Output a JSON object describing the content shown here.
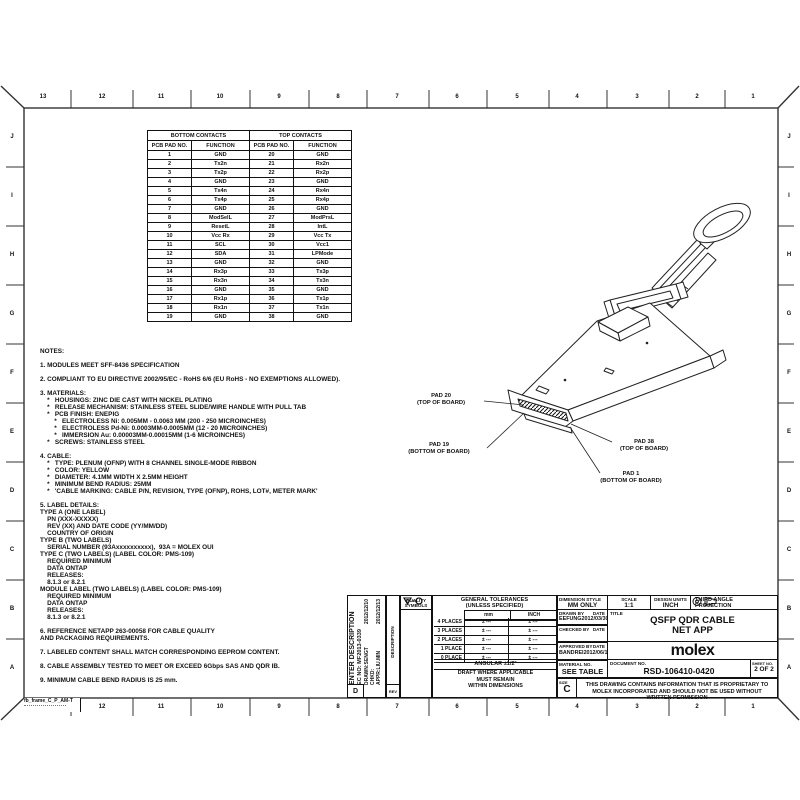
{
  "frame": {
    "top_columns": [
      "13",
      "12",
      "11",
      "10",
      "9",
      "8",
      "7",
      "6",
      "5",
      "4",
      "3",
      "2",
      "1"
    ],
    "bottom_columns": [
      "12",
      "11",
      "10",
      "9",
      "8",
      "7",
      "6",
      "5",
      "4",
      "3",
      "2",
      "1"
    ],
    "rows": [
      "J",
      "I",
      "H",
      "G",
      "F",
      "E",
      "D",
      "C",
      "B",
      "A"
    ],
    "corner_note": "fb_frame_C_P_AM-T"
  },
  "contacts_table": {
    "group_headers": [
      "BOTTOM CONTACTS",
      "TOP CONTACTS"
    ],
    "col_headers": [
      "PCB PAD NO.",
      "FUNCTION",
      "PCB PAD NO.",
      "FUNCTION"
    ],
    "rows": [
      [
        "1",
        "GND",
        "20",
        "GND"
      ],
      [
        "2",
        "Tx2n",
        "21",
        "Rx2n"
      ],
      [
        "3",
        "Tx2p",
        "22",
        "Rx2p"
      ],
      [
        "4",
        "GND",
        "23",
        "GND"
      ],
      [
        "5",
        "Tx4n",
        "24",
        "Rx4n"
      ],
      [
        "6",
        "Tx4p",
        "25",
        "Rx4p"
      ],
      [
        "7",
        "GND",
        "26",
        "GND"
      ],
      [
        "8",
        "ModSelL",
        "27",
        "ModPrsL"
      ],
      [
        "9",
        "ResetL",
        "28",
        "IntL"
      ],
      [
        "10",
        "Vcc Rx",
        "29",
        "Vcc Tx"
      ],
      [
        "11",
        "SCL",
        "30",
        "Vcc1"
      ],
      [
        "12",
        "SDA",
        "31",
        "LPMode"
      ],
      [
        "13",
        "GND",
        "32",
        "GND"
      ],
      [
        "14",
        "Rx3p",
        "33",
        "Tx3p"
      ],
      [
        "15",
        "Rx3n",
        "34",
        "Tx3n"
      ],
      [
        "16",
        "GND",
        "35",
        "GND"
      ],
      [
        "17",
        "Rx1p",
        "36",
        "Tx1p"
      ],
      [
        "18",
        "Rx1n",
        "37",
        "Tx1n"
      ],
      [
        "19",
        "GND",
        "38",
        "GND"
      ]
    ]
  },
  "notes": {
    "text": "NOTES:\n\n1. MODULES MEET SFF-8436 SPECIFICATION\n\n2. COMPLIANT TO EU DIRECTIVE 2002/95/EC - RoHS 6/6 (EU RoHS - NO EXEMPTIONS ALLOWED).\n\n3. MATERIALS:\n    *   HOUSINGS: ZINC DIE CAST WITH NICKEL PLATING\n    *   RELEASE MECHANISM: STAINLESS STEEL SLIDE/WIRE HANDLE WITH PULL TAB\n    *   PCB FINISH: ENEPIG\n        *   ELECTROLESS Ni: 0.005MM - 0.0063 MM (200 - 250 MICROINCHES)\n        *   ELECTROLESS Pd-Ni: 0.0003MM-0.0005MM (12 - 20 MICROINCHES)\n        *   IMMERSION Au: 0.00003MM-0.00015MM (1-6 MICROINCHES)\n    *   SCREWS: STAINLESS STEEL\n\n4. CABLE:\n    *   TYPE: PLENUM (OFNP) WITH 8 CHANNEL SINGLE-MODE RIBBON\n    *   COLOR: YELLOW\n    *   DIAMETER: 4.1MM WIDTH X 2.5MM HEIGHT\n    *   MINIMUM BEND RADIUS: 25MM\n    *   'CABLE MARKING: CABLE P/N, REVISION, TYPE (OFNP), ROHS, LOT#, METER MARK'\n\n5. LABEL DETAILS:\nTYPE A (ONE LABEL)\n    PN (XXX-XXXXX)\n    REV (XX) AND DATE CODE (YY/MM/DD)\n    COUNTRY OF ORIGIN\nTYPE B (TWO LABELS)\n    SERIAL NUMBER (93Axxxxxxxxxx),  93A = MOLEX OUI\nTYPE C (TWO LABELS) (LABEL COLOR: PMS-109)\n    REQUIRED MINIMUM\n    DATA ONTAP\n    RELEASES:\n    8.1.3 or 8.2.1\nMODULE LABEL (TWO LABELS) (LABEL COLOR: PMS-109)\n    REQUIRED MINIMUM\n    DATA ONTAP\n    RELEASES:\n    8.1.3 or 8.2.1\n\n6. REFERENCE NETAPP 263-00058 FOR CABLE QUALITY\nAND PACKAGING REQUIREMENTS.\n\n7. LABELED CONTENT SHALL MATCH CORRESPONDING EEPROM CONTENT.\n\n8. CABLE ASSEMBLY TESTED TO MEET OR EXCEED 6Gbps SAS AND QDR IB.\n\n9. MINIMUM CABLE BEND RADIUS IS 25 mm."
  },
  "drawing": {
    "pad20": {
      "l1": "PAD 20",
      "l2": "(TOP OF BOARD)"
    },
    "pad19": {
      "l1": "PAD 19",
      "l2": "(BOTTOM OF BOARD)"
    },
    "pad38": {
      "l1": "PAD 38",
      "l2": "(TOP OF BOARD)"
    },
    "pad1": {
      "l1": "PAD 1",
      "l2": "(BOTTOM OF BOARD)"
    }
  },
  "title_block": {
    "revision": {
      "enter_description": "ENTER DESCRIPTION",
      "ec_no": "EC NO: MF2013-0339",
      "drawn": "DRAWN:SENGT",
      "drawn_date": "2012/12/10",
      "chkd": "CHKD:",
      "appr": "APPR:LIU.MIN",
      "appr_date": "2012/12/13",
      "description_label": "DESCRIPTION",
      "rev_label": "REV",
      "rev_letter": "D"
    },
    "quality": {
      "header1": "QUALITY",
      "header2": "SYMBOLS"
    },
    "tolerances": {
      "title1": "GENERAL TOLERANCES",
      "title2": "(UNLESS SPECIFIED)",
      "col_mm": "mm",
      "col_inch": "INCH",
      "rows": [
        {
          "label": "4 PLACES",
          "mm": "± ---",
          "inch": "± ---"
        },
        {
          "label": "3 PLACES",
          "mm": "± ---",
          "inch": "± ---"
        },
        {
          "label": "2 PLACES",
          "mm": "± ---",
          "inch": "± ---"
        },
        {
          "label": "1 PLACE",
          "mm": "± ---",
          "inch": "± ---"
        },
        {
          "label": "0 PLACE",
          "mm": "± ---",
          "inch": "± ---"
        }
      ],
      "angular": "ANGULAR ±1/2°",
      "draft_note": "DRAFT WHERE APPLICABLE\nMUST REMAIN\nWITHIN DIMENSIONS"
    },
    "dimension_style": {
      "label": "DIMENSION STYLE",
      "value": "MM ONLY"
    },
    "drawn_by": {
      "label": "DRAWN BY",
      "date_label": "DATE",
      "name": "EEFUNG",
      "date": "2012/03/30"
    },
    "checked_by": {
      "label": "CHECKED BY",
      "date_label": "DATE",
      "name": "",
      "date": ""
    },
    "approved_by": {
      "label": "APPROVED BY",
      "date_label": "DATE",
      "name": "BANDREI",
      "date": "2012/06/18"
    },
    "material": {
      "label": "MATERIAL NO.",
      "value": "SEE TABLE"
    },
    "scale": {
      "label": "SCALE",
      "value": "1:1"
    },
    "design_units": {
      "label": "DESIGN UNITS",
      "value": "INCH"
    },
    "projection": {
      "line1": "THIRD ANGLE",
      "line2": "PROJECTION"
    },
    "title": {
      "label": "TITLE",
      "line1": "QSFP QDR CABLE",
      "line2": "NET APP"
    },
    "logo": "molex",
    "document_no": {
      "label": "DOCUMENT NO.",
      "value": "RSD-106410-0420"
    },
    "sheet": {
      "label": "SHEET NO.",
      "value": "2 OF 2"
    },
    "size": {
      "label": "SIZE",
      "value": "C"
    },
    "proprietary": "THIS DRAWING CONTAINS INFORMATION THAT IS PROPRIETARY TO MOLEX INCORPORATED AND SHOULD NOT BE USED WITHOUT WRITTEN PERMISSION"
  }
}
